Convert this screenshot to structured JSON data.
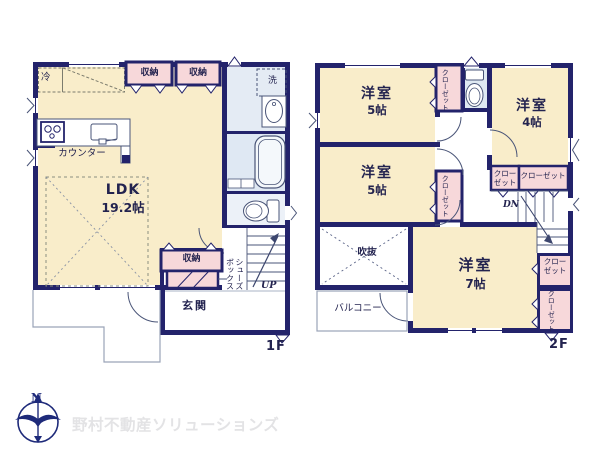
{
  "floor1": {
    "label": "1F",
    "ldk_name": "LDK",
    "ldk_area": "19.2帖",
    "counter": "カウンター",
    "refrigerator": "冷",
    "storage_a": "収納",
    "storage_b": "収納",
    "laundry": "洗",
    "storage_c": "収納",
    "shoe_box": "シューズ\nボックス",
    "entrance": "玄関",
    "stairs": "UP"
  },
  "floor2": {
    "label": "2F",
    "bedroom1_name": "洋室",
    "bedroom1_area": "5帖",
    "bedroom2_name": "洋室",
    "bedroom2_area": "5帖",
    "bedroom3_name": "洋室",
    "bedroom3_area": "4帖",
    "bedroom4_name": "洋室",
    "bedroom4_area": "7帖",
    "closet_a": "クローゼット",
    "closet_b": "クローゼット",
    "closet_c": "クロー\nゼット",
    "closet_d": "クローゼット",
    "closet_e": "クロー\nゼット",
    "closet_f": "クローゼット",
    "void": "吹抜",
    "balcony": "バルコニー",
    "stairs": "DN"
  },
  "branding": {
    "compass_north": "N",
    "watermark": "野村不動産ソリューションズ"
  },
  "colors": {
    "wall": "#23236b",
    "room_fill": "#f9edca",
    "closet_fill": "#f7d8da",
    "wet_area_fill": "#e2eaf3",
    "watermark_text": "#e3e3e5",
    "logo_blue": "#1e2a7a"
  }
}
